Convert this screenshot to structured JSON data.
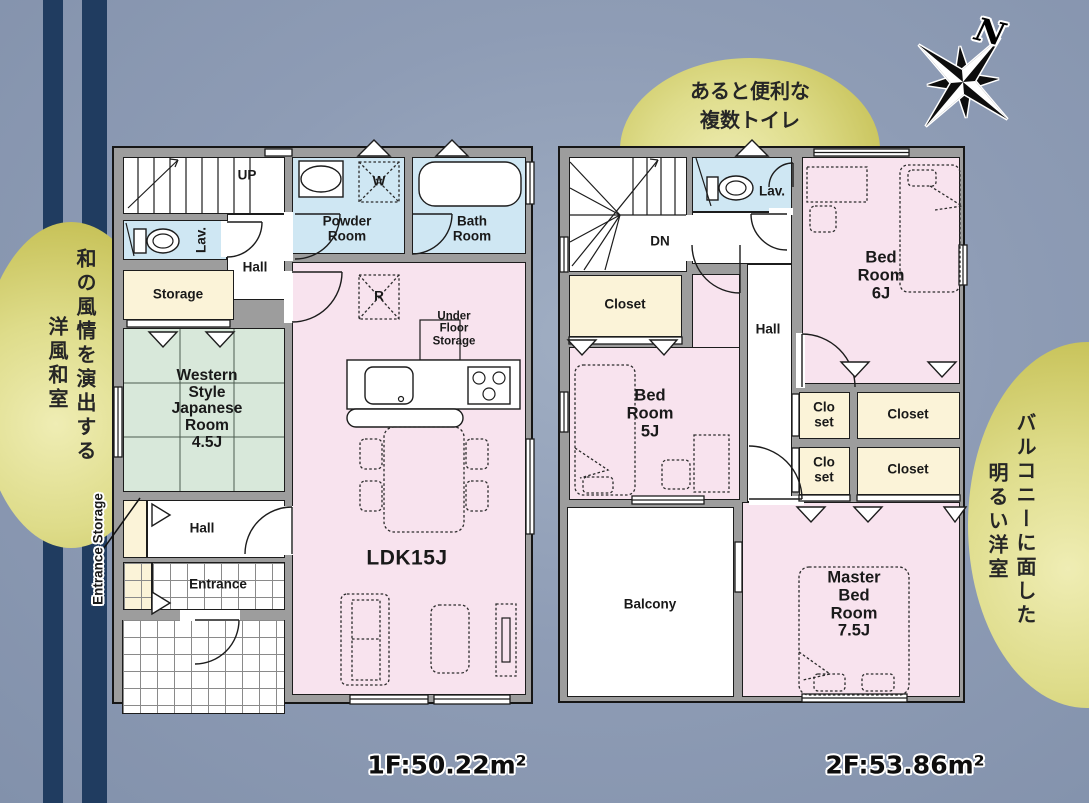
{
  "colors": {
    "wall": "#9d9d9d",
    "room_pink": "#f8e3ee",
    "room_blue": "#cfe7f3",
    "room_cream": "#fbf3d8",
    "room_green": "#d8e8da",
    "stripe_navy": "#203c60",
    "callout_olive": "#d6d37e",
    "background": "#8e9cb5"
  },
  "compass": {
    "north": "N"
  },
  "callouts": {
    "top": "あると便利な\n複数トイレ",
    "left_main": "和の風情を演出する",
    "left_sub": "洋風和室",
    "right_main": "バルコニーに面した",
    "right_sub": "明るい洋室"
  },
  "areas": {
    "f1": "1F:50.22m²",
    "f2": "2F:53.86m²"
  },
  "floor1": {
    "up": "UP",
    "lav": "Lav.",
    "hall_upper": "Hall",
    "powder_room": "Powder\nRoom",
    "bath_room": "Bath\nRoom",
    "washer": "W",
    "storage": "Storage",
    "japanese_room": "Western\nStyle\nJapanese\nRoom\n4.5J",
    "fridge": "R",
    "under_floor_storage": "Under\nFloor\nStorage",
    "ldk": "LDK15J",
    "hall_lower": "Hall",
    "entrance": "Entrance",
    "entrance_storage": "Entrance Storage"
  },
  "floor2": {
    "dn": "DN",
    "lav": "Lav.",
    "hall": "Hall",
    "closet": "Closet",
    "bed6": "Bed\nRoom\n6J",
    "bed5": "Bed\nRoom\n5J",
    "clo_set_1": "Clo\nset",
    "closet_1": "Closet",
    "clo_set_2": "Clo\nset",
    "closet_2": "Closet",
    "balcony": "Balcony",
    "master": "Master\nBed\nRoom\n7.5J"
  }
}
